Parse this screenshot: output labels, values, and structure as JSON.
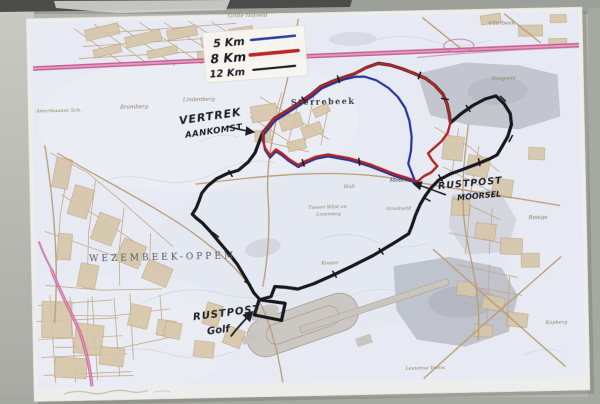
{
  "legend": {
    "items": [
      {
        "id": "5km",
        "label": "5 Km",
        "color": "#2b3ba0"
      },
      {
        "id": "8km",
        "label": "8 Km",
        "color": "#bb2727"
      },
      {
        "id": "12km",
        "label": "12 Km",
        "color": "#1c1c24"
      }
    ]
  },
  "annotations": {
    "start": {
      "line1": "VERTREK",
      "line2": "AANKOMST"
    },
    "rest_moorsel": {
      "line1": "RUSTPOST",
      "line2": "MOORSEL"
    },
    "rest_golf": {
      "line1": "RUSTPOST",
      "line2": "Golf"
    }
  },
  "map_labels": {
    "grote_hofveld": "Grote Hofveld",
    "lindenberg": "Lindenberg",
    "sterrebeek": "Sterrebeek",
    "vlierbeek": "Vlierbeek",
    "hoogveld": "Hoogveld",
    "bromberg": "Bromberg",
    "amerikaanse": "Amerikaanse Sch.",
    "wezembeek": "WEZEMBEEK-OPPEM",
    "moorsel": "Moorsel",
    "hult": "Hult",
    "tussen1": "Tussen Wilst en",
    "tussen2": "Lozenweg",
    "grootveld": "Grootveld",
    "rooige": "Rooige",
    "kapberg": "Kapberg",
    "kouter": "Kouter",
    "leuvense": "Leuvense Voetw."
  },
  "routes": [
    {
      "id": "12km",
      "name": "12 Km route",
      "color": "#17171d",
      "stroke_width": 3.2,
      "points": [
        [
          264,
          132
        ],
        [
          276,
          118
        ],
        [
          288,
          111
        ],
        [
          301,
          103
        ],
        [
          313,
          95
        ],
        [
          323,
          87
        ],
        [
          335,
          82
        ],
        [
          347,
          78
        ],
        [
          357,
          75
        ],
        [
          369,
          69
        ],
        [
          381,
          65
        ],
        [
          393,
          67
        ],
        [
          405,
          71
        ],
        [
          417,
          76
        ],
        [
          428,
          81
        ],
        [
          437,
          88
        ],
        [
          445,
          97
        ],
        [
          449,
          107
        ],
        [
          451,
          117
        ],
        [
          452,
          126
        ],
        [
          463,
          117
        ],
        [
          475,
          109
        ],
        [
          487,
          103
        ],
        [
          498,
          100
        ],
        [
          506,
          108
        ],
        [
          512,
          118
        ],
        [
          513,
          129
        ],
        [
          509,
          141
        ],
        [
          503,
          151
        ],
        [
          498,
          159
        ],
        [
          490,
          163
        ],
        [
          477,
          168
        ],
        [
          463,
          173
        ],
        [
          451,
          177
        ],
        [
          439,
          183
        ],
        [
          431,
          191
        ],
        [
          425,
          199
        ],
        [
          420,
          207
        ],
        [
          415,
          218
        ],
        [
          411,
          229
        ],
        [
          408,
          236
        ],
        [
          393,
          245
        ],
        [
          372,
          257
        ],
        [
          351,
          267
        ],
        [
          331,
          276
        ],
        [
          312,
          284
        ],
        [
          296,
          289
        ],
        [
          284,
          287
        ],
        [
          273,
          286
        ],
        [
          269,
          296
        ],
        [
          257,
          299
        ],
        [
          252,
          314
        ],
        [
          279,
          320
        ],
        [
          283,
          303
        ],
        [
          258,
          299
        ],
        [
          252,
          292
        ],
        [
          244,
          277
        ],
        [
          236,
          263
        ],
        [
          227,
          251
        ],
        [
          218,
          240
        ],
        [
          210,
          230
        ],
        [
          202,
          221
        ],
        [
          196,
          216
        ],
        [
          192,
          212
        ],
        [
          196,
          206
        ],
        [
          199,
          199
        ],
        [
          202,
          191
        ],
        [
          208,
          184
        ],
        [
          217,
          177
        ],
        [
          228,
          172
        ],
        [
          239,
          169
        ],
        [
          249,
          161
        ],
        [
          256,
          152
        ],
        [
          260,
          142
        ],
        [
          264,
          132
        ]
      ]
    },
    {
      "id": "5km",
      "name": "5 Km route",
      "color": "#27349b",
      "stroke_width": 2.2,
      "points": [
        [
          265,
          134
        ],
        [
          277,
          120
        ],
        [
          289,
          113
        ],
        [
          302,
          105
        ],
        [
          314,
          97
        ],
        [
          324,
          89
        ],
        [
          336,
          84
        ],
        [
          348,
          80
        ],
        [
          358,
          78
        ],
        [
          367,
          78
        ],
        [
          379,
          82
        ],
        [
          391,
          90
        ],
        [
          400,
          99
        ],
        [
          407,
          110
        ],
        [
          411,
          123
        ],
        [
          413,
          139
        ],
        [
          412,
          153
        ],
        [
          409,
          166
        ],
        [
          413,
          177
        ],
        [
          416,
          185
        ],
        [
          407,
          182
        ],
        [
          395,
          178
        ],
        [
          383,
          173
        ],
        [
          371,
          168
        ],
        [
          359,
          164
        ],
        [
          349,
          161
        ],
        [
          339,
          159
        ],
        [
          329,
          157
        ],
        [
          317,
          159
        ],
        [
          307,
          163
        ],
        [
          299,
          167
        ],
        [
          290,
          161
        ],
        [
          283,
          155
        ],
        [
          277,
          151
        ],
        [
          271,
          157
        ],
        [
          266,
          149
        ],
        [
          265,
          141
        ],
        [
          265,
          134
        ]
      ]
    },
    {
      "id": "8km",
      "name": "8 Km route",
      "color": "#b22525",
      "stroke_width": 2.4,
      "points": [
        [
          264,
          132
        ],
        [
          276,
          118
        ],
        [
          288,
          111
        ],
        [
          301,
          103
        ],
        [
          313,
          95
        ],
        [
          323,
          87
        ],
        [
          335,
          82
        ],
        [
          347,
          78
        ],
        [
          357,
          75
        ],
        [
          369,
          69
        ],
        [
          381,
          65
        ],
        [
          393,
          67
        ],
        [
          405,
          71
        ],
        [
          417,
          76
        ],
        [
          428,
          81
        ],
        [
          437,
          88
        ],
        [
          445,
          97
        ],
        [
          449,
          107
        ],
        [
          451,
          117
        ],
        [
          452,
          126
        ],
        [
          449,
          136
        ],
        [
          443,
          144
        ],
        [
          436,
          150
        ],
        [
          429,
          156
        ],
        [
          433,
          163
        ],
        [
          438,
          169
        ],
        [
          432,
          175
        ],
        [
          424,
          179
        ],
        [
          418,
          184
        ],
        [
          407,
          180
        ],
        [
          395,
          176
        ],
        [
          383,
          171
        ],
        [
          371,
          166
        ],
        [
          359,
          162
        ],
        [
          349,
          159
        ],
        [
          339,
          157
        ],
        [
          329,
          155
        ],
        [
          317,
          157
        ],
        [
          307,
          161
        ],
        [
          299,
          165
        ],
        [
          290,
          159
        ],
        [
          283,
          153
        ],
        [
          277,
          149
        ],
        [
          271,
          155
        ],
        [
          266,
          147
        ],
        [
          264,
          139
        ],
        [
          264,
          132
        ]
      ]
    }
  ],
  "route_ticks": [
    [
      306,
      100,
      55
    ],
    [
      341,
      80,
      75
    ],
    [
      422,
      78,
      110
    ],
    [
      447,
      102,
      10
    ],
    [
      470,
      112,
      60
    ],
    [
      505,
      103,
      45
    ],
    [
      512,
      143,
      120
    ],
    [
      480,
      166,
      80
    ],
    [
      441,
      181,
      60
    ],
    [
      427,
      202,
      30
    ],
    [
      380,
      253,
      55
    ],
    [
      333,
      275,
      60
    ],
    [
      304,
      163,
      75
    ],
    [
      360,
      163,
      85
    ],
    [
      231,
      172,
      60
    ],
    [
      215,
      233,
      40
    ],
    [
      246,
      282,
      30
    ]
  ],
  "colors": {
    "wall": "#b3b6ae",
    "paper": "#edeeec",
    "map_base": "#e7eaf2",
    "highway_pink": "#bf5790",
    "handwriting": "#1d1d24"
  }
}
